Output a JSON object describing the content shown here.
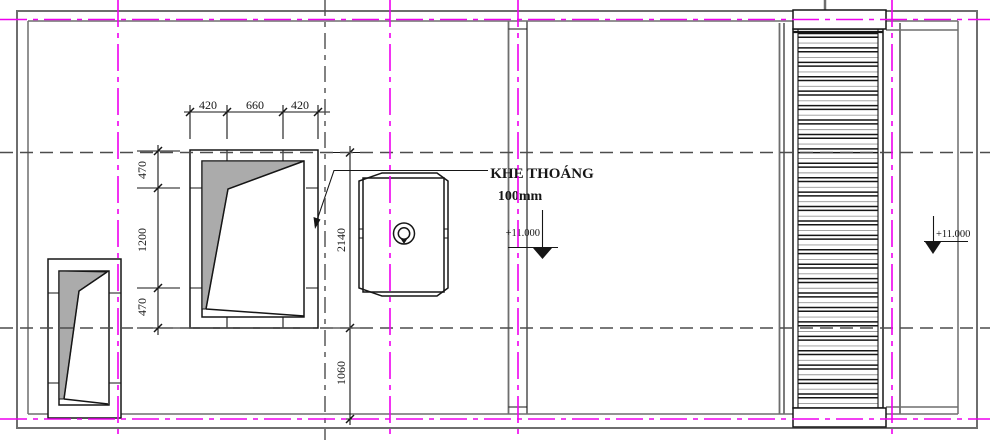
{
  "drawing": {
    "annotation": {
      "line1": "KHE THOÁNG",
      "line2": "100mm"
    },
    "elevation_markers": [
      {
        "value": "+11.000"
      },
      {
        "value": "+11.000"
      }
    ],
    "dims": {
      "top": [
        "420",
        "660",
        "420"
      ],
      "left": [
        "470",
        "1200",
        "470"
      ],
      "right": [
        "2140",
        "1060"
      ]
    },
    "louver": {
      "slat_count": 26,
      "period": 14.42,
      "y_start": 33.5,
      "x1": 798,
      "x2": 878
    },
    "colors": {
      "outline": "#6e6e6e",
      "detail": "#161616",
      "centerline": "#4d4d4d",
      "axis_magenta": "#ee00ee",
      "glass_gray": "#ababab"
    }
  }
}
